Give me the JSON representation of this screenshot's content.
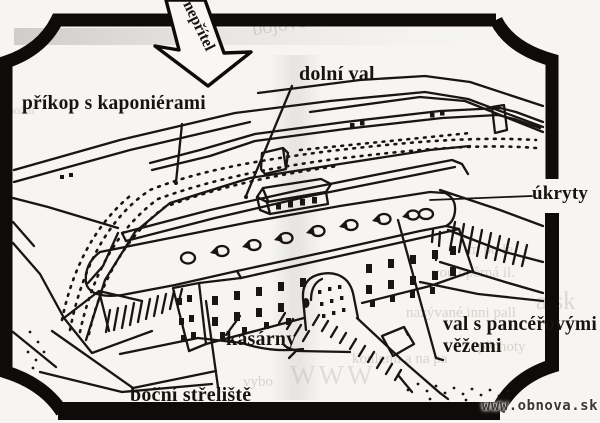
{
  "figure": {
    "labels": {
      "enemy": "nepřítel",
      "moat": "příkop s kaponiérami",
      "lower_rampart": "dolní val",
      "shelters": "úkryty",
      "barracks": "kasárny",
      "armored_rampart_line1": "val s pancéřovými",
      "armored_rampart_line2": "věžemi",
      "side_range": "boční střeliště"
    },
    "watermark": "www.obnova.sk",
    "ghost_texts": {
      "g1": "bojové",
      "g2": "požní",
      "g3": "m po le",
      "g4": "vou opěrná il.",
      "g5": "nazývané inni pall",
      "g6": "koulemi a na pa",
      "g7": "pěchoty",
      "g8": "WWW",
      "g9": "a.sk",
      "g10": "vybo"
    },
    "colors": {
      "ink": "#181512",
      "frame": "#0d0c0b",
      "paper": "#f6f5f2",
      "ghost": "#b0aba2",
      "watermark": "#3b3733"
    }
  }
}
